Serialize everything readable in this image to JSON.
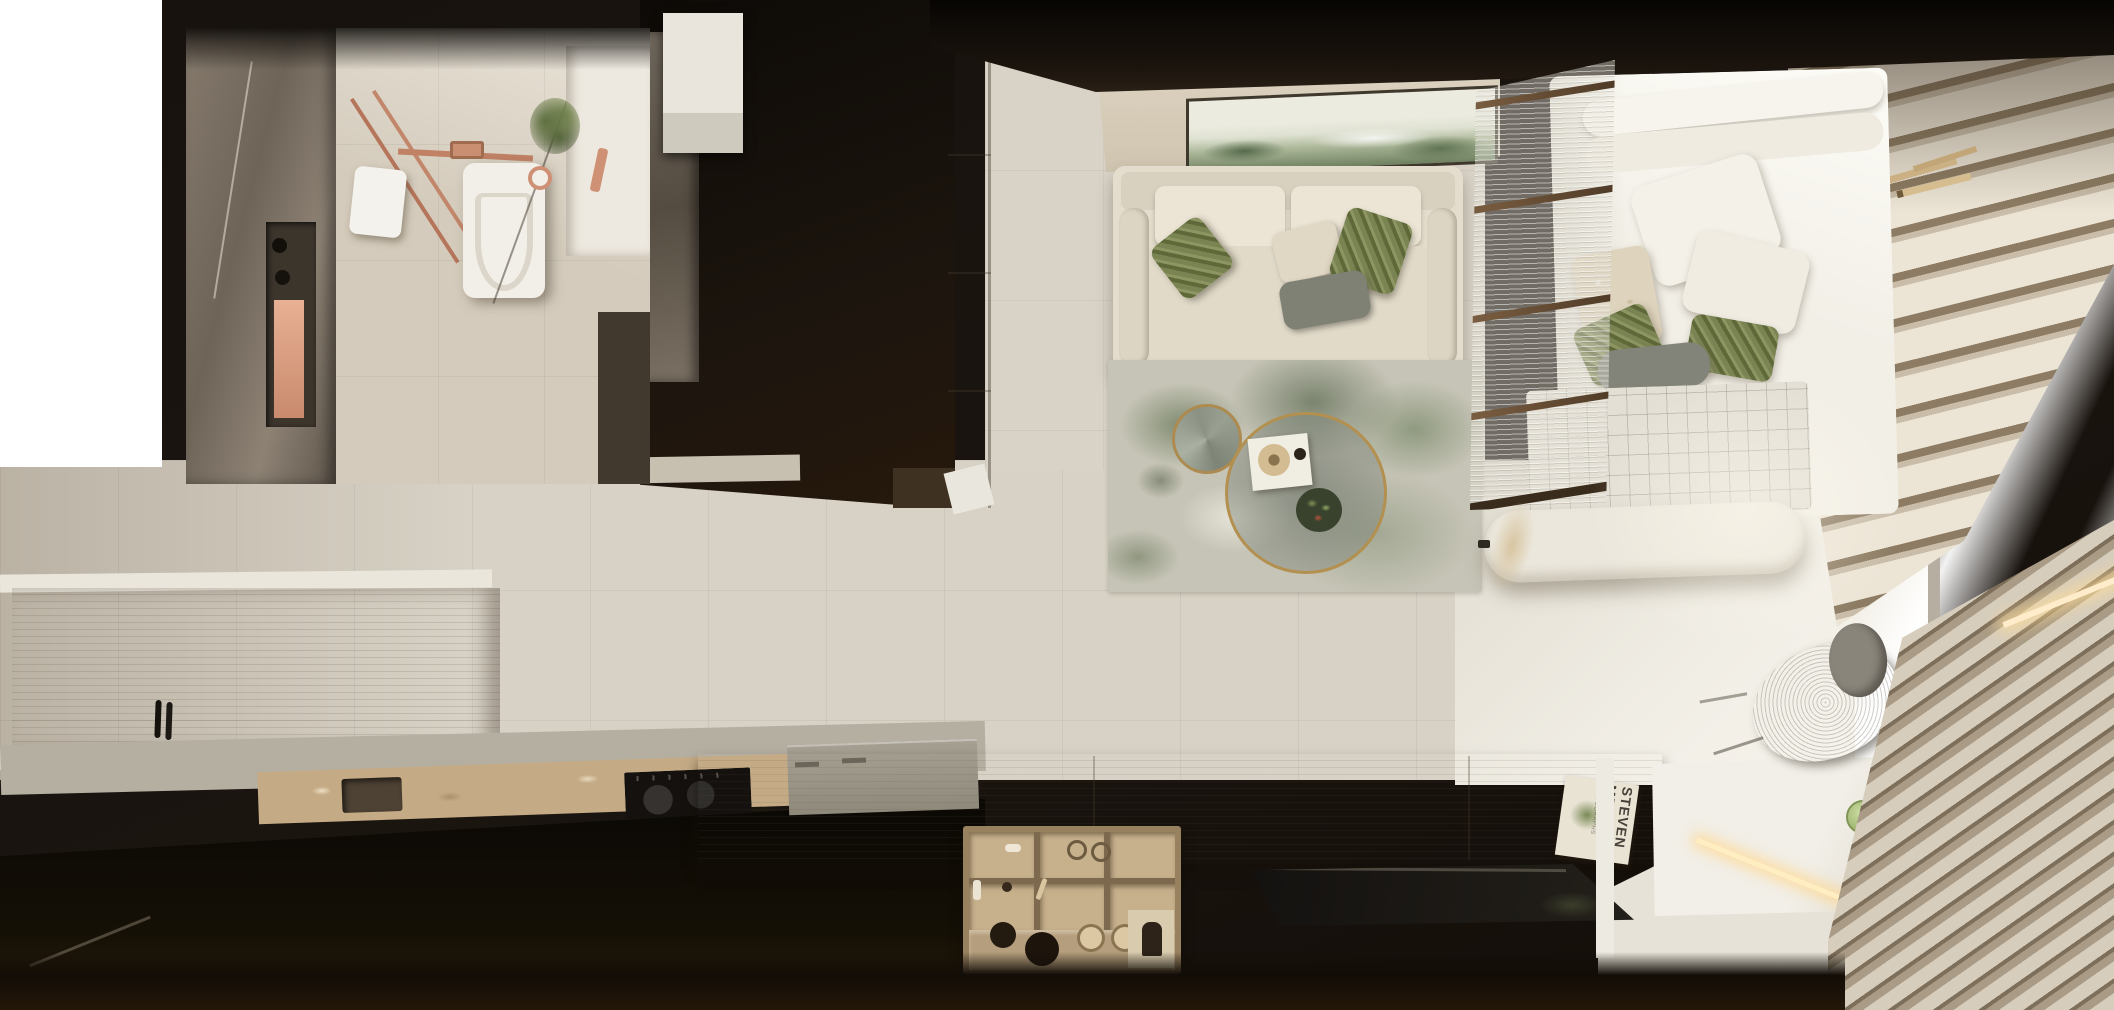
{
  "meta": {
    "type": "3d-interior-render",
    "view": "top-down (bird's-eye) render of a studio apartment",
    "dimensions": {
      "width": 2114,
      "height": 1010
    }
  },
  "scene": {
    "book": {
      "line1": "STEVEN",
      "line2": "MEISEL",
      "sub": "PHOTOGRAPHS"
    },
    "rooms": [
      {
        "name": "bathroom",
        "objects": [
          "grey marble shower wall",
          "recessed niche with copper shelf",
          "black shower controls",
          "copper exposed pipes",
          "wall-hung toilet",
          "white towel",
          "copper floor drain",
          "vanity with plant",
          "dark marble shower floor"
        ]
      },
      {
        "name": "hallway",
        "objects": [
          "dark wall zone",
          "white wall cabinet",
          "marble door slab",
          "cream wardrobe column",
          "beige tile floor"
        ]
      },
      {
        "name": "kitchen",
        "objects": [
          "oak cabinet run",
          "white counter edges",
          "grey worktop",
          "travertine counter",
          "undermount sink",
          "black two-zone induction hob",
          "black faucet",
          "black island base"
        ]
      },
      {
        "name": "living-room",
        "objects": [
          "wall shelf console",
          "abstract green landscape artwork",
          "cream three-seat sofa",
          "olive ribbed pillows",
          "cream pillow",
          "grey pillow",
          "abstract green-grey rug",
          "brass-rim glass coffee table",
          "brass geometric side table",
          "white tray with hat and cup",
          "plant bowl"
        ]
      },
      {
        "name": "bedroom",
        "objects": [
          "fluted glass partition with bronze rails",
          "white bed",
          "headboard bolsters",
          "white and green pillows",
          "quilted grid blanket",
          "white bench",
          "pampas decor",
          "hanging plant on rattan tray",
          "bamboo sticks"
        ]
      },
      {
        "name": "workspace",
        "objects": [
          "white desk",
          "warm LED strip",
          "grey mesh office chair",
          "green glass cups",
          "photo book",
          "plant sprigs"
        ]
      },
      {
        "name": "media-wall",
        "objects": [
          "oak sideboard",
          "open drawer with wood organizers",
          "cosmetics and accessories",
          "flat black TV"
        ]
      },
      {
        "name": "window-side",
        "objects": [
          "stacked drape folds",
          "sheer curtain",
          "window mullion",
          "venetian blinds",
          "sunlight glow"
        ]
      }
    ],
    "palette": {
      "floor": "#d8d2c6",
      "dark_wall": "#17120e",
      "marble": "#7b7165",
      "copper": "#c08a6e",
      "oak": "#c4b295",
      "travertine": "#c5ab85",
      "sofa": "#e4ddcd",
      "olive": "#75804f",
      "rug_green": "#7d8a6a",
      "bronze": "#6d5339",
      "bed_white": "#f2efe7",
      "led_glow": "#ffeec2",
      "tv_black": "#161310",
      "window_light": "#f7f4ed"
    }
  }
}
